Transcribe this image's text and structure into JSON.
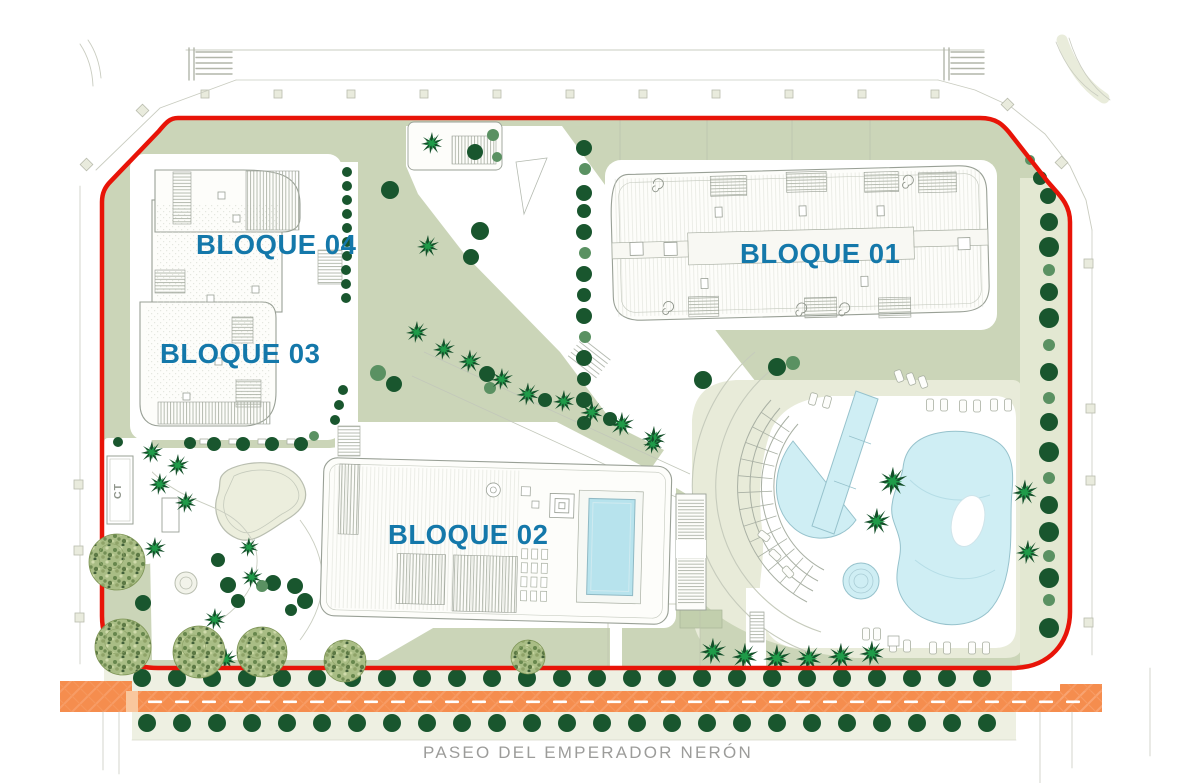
{
  "labels": {
    "block01": "BLOQUE 01",
    "block02": "BLOQUE 02",
    "block03": "BLOQUE 03",
    "block04": "BLOQUE 04",
    "ct": "CT",
    "street": "PASEO DEL EMPERADOR NERÓN"
  },
  "map": {
    "palette": {
      "boundary_red": "#e81408",
      "label_blue": "#1478aa",
      "sage": "#cbd5b8",
      "pale_strip": "#e3e8d2",
      "deck_beige": "#e8ebd9",
      "verge": "#eef0e2",
      "road_orange": "#f58d4e",
      "road_hatch": "#f9ab7d",
      "pool_blue": "#cfeef4",
      "pool_edge": "#96c2cc",
      "roof_pool": "#b7e3ed",
      "building_fill": "#fdfdfa",
      "building_line": "#99a096",
      "tree_dark": "#19562e",
      "tree_mid": "#5a9162",
      "palm_bright": "#1f9b49",
      "palm_dark": "#14502a",
      "street_text": "#9c9c9a",
      "outside_line": "#c9ccc0"
    },
    "trees": {
      "rows": {
        "y1": 678,
        "x1": 142,
        "count1": 25,
        "y2": 723,
        "x2": 147,
        "count2": 25,
        "step": 35,
        "r": 9
      },
      "round_dark": [
        [
          347,
          172,
          5
        ],
        [
          347,
          186,
          5
        ],
        [
          347,
          200,
          5
        ],
        [
          347,
          214,
          5
        ],
        [
          347,
          228,
          5
        ],
        [
          347,
          242,
          5
        ],
        [
          347,
          256,
          5
        ],
        [
          346,
          270,
          5
        ],
        [
          346,
          284,
          5
        ],
        [
          346,
          298,
          5
        ],
        [
          343,
          390,
          5
        ],
        [
          339,
          405,
          5
        ],
        [
          335,
          420,
          5
        ],
        [
          584,
          148,
          8
        ],
        [
          584,
          193,
          8
        ],
        [
          584,
          211,
          7
        ],
        [
          584,
          232,
          8
        ],
        [
          584,
          274,
          8
        ],
        [
          584,
          295,
          7
        ],
        [
          584,
          316,
          8
        ],
        [
          584,
          358,
          8
        ],
        [
          584,
          379,
          7
        ],
        [
          584,
          400,
          8
        ],
        [
          584,
          423,
          7
        ],
        [
          1040,
          178,
          7
        ],
        [
          1048,
          196,
          8
        ],
        [
          1049,
          222,
          9
        ],
        [
          1049,
          247,
          10
        ],
        [
          1049,
          292,
          9
        ],
        [
          1049,
          318,
          10
        ],
        [
          1049,
          372,
          9
        ],
        [
          1049,
          422,
          9
        ],
        [
          1049,
          452,
          10
        ],
        [
          1049,
          505,
          9
        ],
        [
          1049,
          532,
          10
        ],
        [
          1049,
          578,
          10
        ],
        [
          1049,
          628,
          10
        ],
        [
          475,
          152,
          8
        ],
        [
          390,
          190,
          9
        ],
        [
          480,
          231,
          9
        ],
        [
          471,
          257,
          8
        ],
        [
          394,
          384,
          8
        ],
        [
          487,
          374,
          8
        ],
        [
          545,
          400,
          7
        ],
        [
          610,
          419,
          7
        ],
        [
          703,
          380,
          9
        ],
        [
          777,
          367,
          9
        ],
        [
          214,
          444,
          7
        ],
        [
          243,
          444,
          7
        ],
        [
          272,
          444,
          7
        ],
        [
          301,
          444,
          7
        ],
        [
          118,
          442,
          5
        ],
        [
          190,
          443,
          6
        ],
        [
          218,
          560,
          7
        ],
        [
          143,
          603,
          8
        ],
        [
          228,
          585,
          8
        ],
        [
          238,
          601,
          7
        ],
        [
          295,
          586,
          8
        ],
        [
          305,
          601,
          8
        ],
        [
          291,
          610,
          6
        ],
        [
          273,
          583,
          8
        ]
      ],
      "round_mid": [
        [
          585,
          169,
          6
        ],
        [
          585,
          253,
          6
        ],
        [
          585,
          337,
          6
        ],
        [
          1049,
          270,
          6
        ],
        [
          1049,
          345,
          6
        ],
        [
          1049,
          398,
          6
        ],
        [
          1049,
          478,
          6
        ],
        [
          1049,
          556,
          6
        ],
        [
          1049,
          600,
          6
        ],
        [
          1030,
          160,
          5
        ],
        [
          497,
          157,
          5
        ],
        [
          493,
          135,
          6
        ],
        [
          378,
          373,
          8
        ],
        [
          793,
          363,
          7
        ],
        [
          490,
          388,
          6
        ],
        [
          314,
          436,
          5
        ],
        [
          262,
          586,
          6
        ]
      ],
      "palm": [
        [
          432,
          143,
          1
        ],
        [
          428,
          246,
          1
        ],
        [
          417,
          332,
          1
        ],
        [
          444,
          349,
          1
        ],
        [
          470,
          361,
          1.05
        ],
        [
          502,
          379,
          1
        ],
        [
          528,
          394,
          1.05
        ],
        [
          564,
          401,
          1
        ],
        [
          592,
          412,
          1.05
        ],
        [
          622,
          424,
          1.1
        ],
        [
          654,
          438,
          1.1
        ],
        [
          653,
          444,
          0.9
        ],
        [
          893,
          481,
          1.3
        ],
        [
          877,
          521,
          1.2
        ],
        [
          1025,
          492,
          1.15
        ],
        [
          1028,
          552,
          1.1
        ],
        [
          713,
          651,
          1.2
        ],
        [
          745,
          656,
          1.2
        ],
        [
          777,
          658,
          1.25
        ],
        [
          809,
          658,
          1.2
        ],
        [
          841,
          656,
          1.2
        ],
        [
          872,
          653,
          1.15
        ],
        [
          152,
          452,
          1
        ],
        [
          178,
          465,
          1
        ],
        [
          160,
          484,
          1
        ],
        [
          186,
          502,
          1
        ],
        [
          155,
          548,
          1
        ],
        [
          249,
          547,
          0.9
        ],
        [
          215,
          619,
          1
        ],
        [
          226,
          659,
          1
        ],
        [
          252,
          577,
          0.95
        ]
      ],
      "mottled": [
        [
          117,
          562,
          28
        ],
        [
          123,
          647,
          28
        ],
        [
          199,
          652,
          26
        ],
        [
          262,
          652,
          25
        ],
        [
          345,
          661,
          21
        ],
        [
          528,
          657,
          17
        ]
      ]
    },
    "loungers": [
      [
        930,
        405,
        0
      ],
      [
        944,
        405,
        0
      ],
      [
        963,
        406,
        0
      ],
      [
        977,
        406,
        0
      ],
      [
        994,
        405,
        0
      ],
      [
        1008,
        405,
        0
      ],
      [
        899,
        376,
        -20
      ],
      [
        911,
        379,
        -20
      ],
      [
        923,
        382,
        -20
      ],
      [
        813,
        399,
        15
      ],
      [
        827,
        402,
        15
      ],
      [
        764,
        536,
        -52
      ],
      [
        775,
        555,
        -47
      ],
      [
        788,
        572,
        -42
      ],
      [
        893,
        646,
        0
      ],
      [
        907,
        646,
        0
      ],
      [
        933,
        648,
        0
      ],
      [
        947,
        648,
        0
      ],
      [
        972,
        648,
        0
      ],
      [
        986,
        648,
        0
      ],
      [
        866,
        634,
        0
      ],
      [
        877,
        634,
        0
      ]
    ]
  }
}
